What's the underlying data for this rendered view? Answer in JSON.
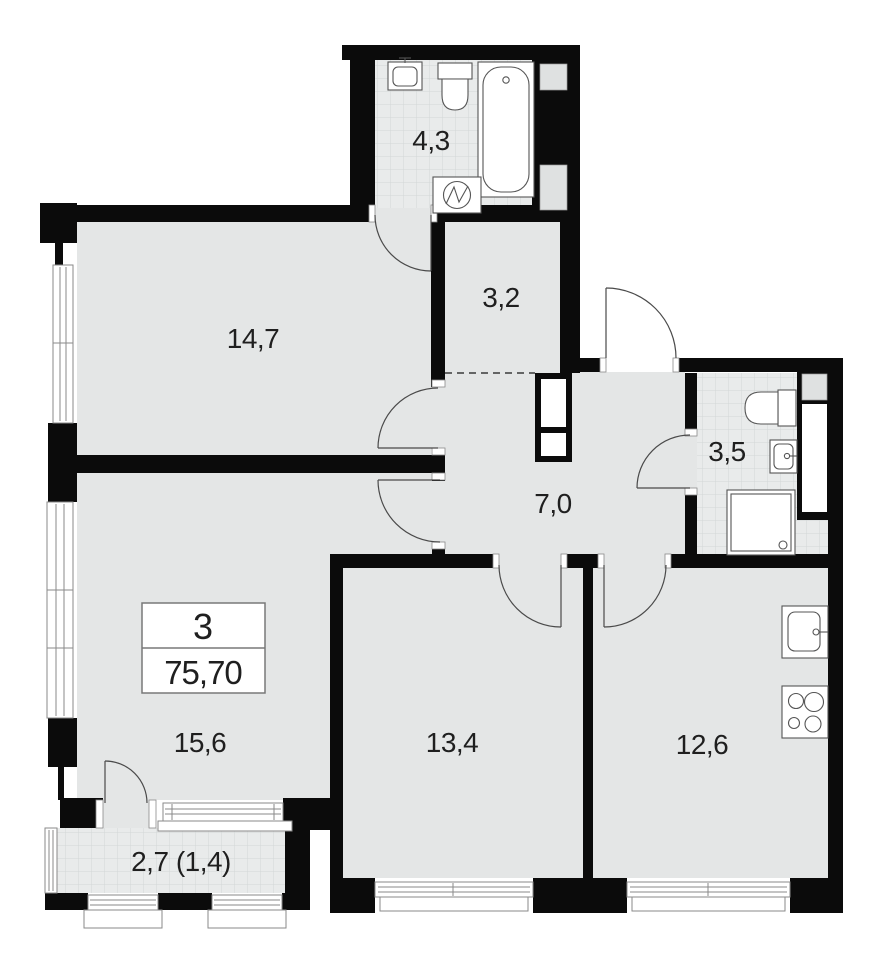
{
  "plan": {
    "unit": {
      "rooms_count": "3",
      "total_area": "75,70"
    },
    "areas": {
      "bathroom_top": "4,3",
      "room_top_left": "14,7",
      "wardrobe": "3,2",
      "hallway": "7,0",
      "bathroom_right": "3,5",
      "room_bottom_left": "15,6",
      "room_bottom_center": "13,4",
      "kitchen": "12,6",
      "balcony": "2,7 (1,4)"
    },
    "icons": [
      "sink-icon",
      "toilet-icon",
      "bathtub-icon",
      "washing-machine-icon",
      "shower-icon",
      "kitchen-sink-icon",
      "stove-icon"
    ],
    "colors": {
      "wall": "#0b0b0b",
      "floor": "#e4e6e6",
      "tile_base": "#e9ebeb",
      "tile_line": "#d2d7d7",
      "door_arc": "#4a4a4a"
    }
  }
}
